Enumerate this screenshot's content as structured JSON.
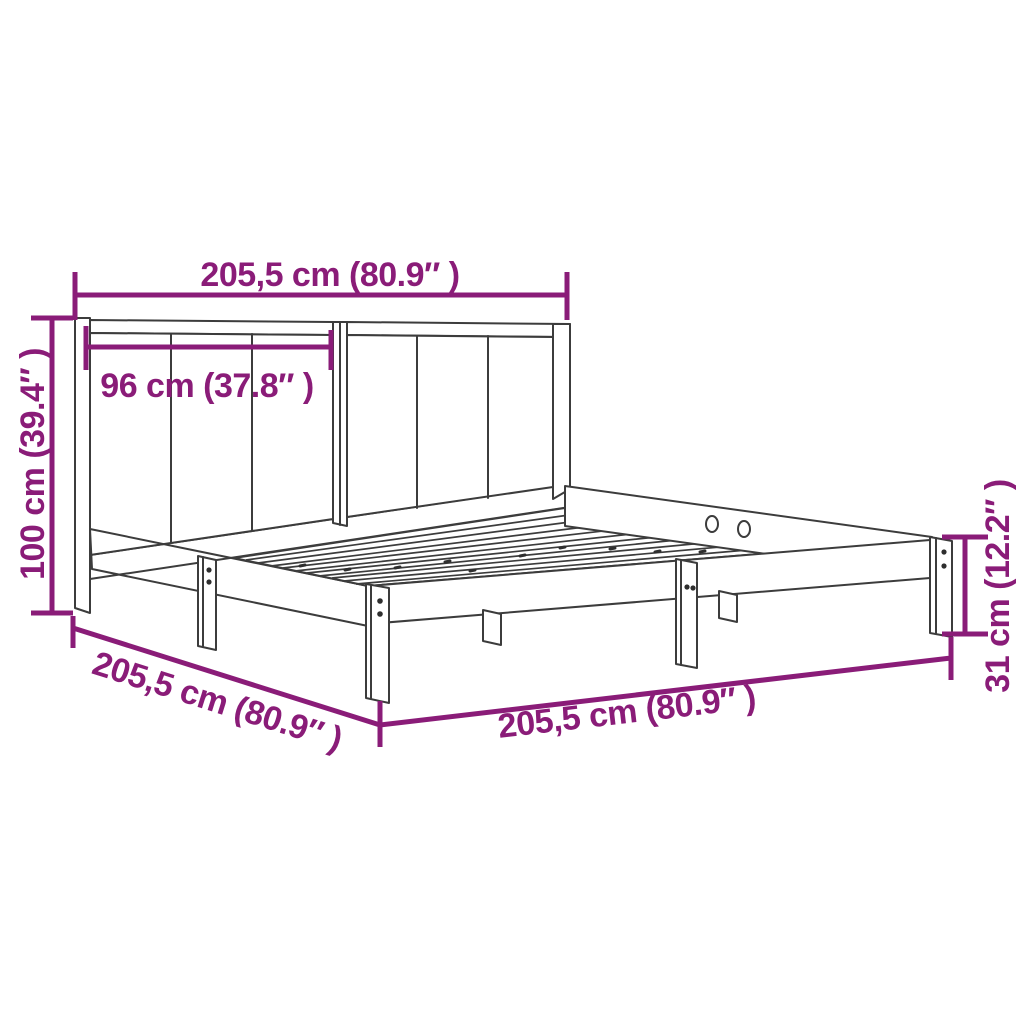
{
  "diagram": {
    "type": "product-dimension-diagram",
    "subject": "wooden bed frame with panelled headboard and slatted base",
    "background_color": "#FFFFFF",
    "drawing_line_color": "#3C3C3C",
    "dimension_color": "#8A1C78",
    "dimensions": {
      "overall_width_top": "205,5 cm (80.9″ )",
      "headboard_panel_width": "96 cm (37.8″ )",
      "headboard_height": "100 cm (39.4″ )",
      "side_depth": "205,5 cm (80.9″ )",
      "overall_width_bottom": "205,5 cm (80.9″ )",
      "base_height": "31 cm (12.2″ )"
    }
  }
}
